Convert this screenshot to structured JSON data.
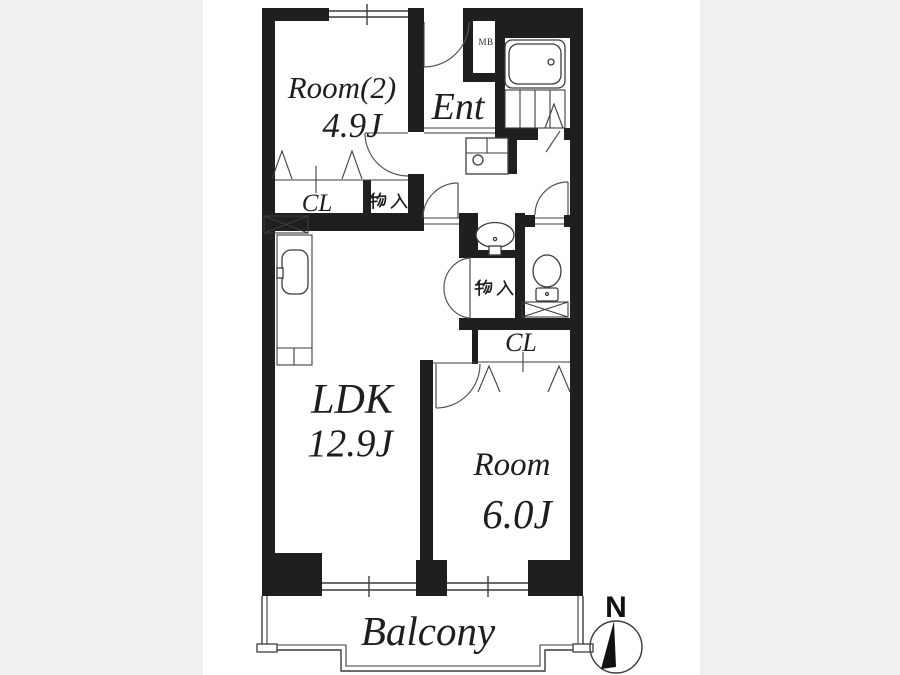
{
  "colors": {
    "wall": "#1f1f1f",
    "line": "#3c3c3c",
    "background": "#ffffff",
    "matte": "#f0f0f0",
    "text": "#1e1e1e"
  },
  "plan": {
    "rooms": {
      "room2": {
        "label": "Room(2)",
        "area": "4.9J"
      },
      "entrance": {
        "label": "Ent"
      },
      "ldk": {
        "label": "LDK",
        "area": "12.9J"
      },
      "bedroom": {
        "label": "Room",
        "area": "6.0J"
      },
      "balcony": {
        "label": "Balcony"
      }
    },
    "closets": {
      "room2_closet": "CL",
      "bedroom_closet": "CL",
      "room2_storage": "物入",
      "hall_storage": "物入"
    },
    "labels": {
      "meter_box": "MB"
    },
    "compass": {
      "north": "N"
    }
  }
}
